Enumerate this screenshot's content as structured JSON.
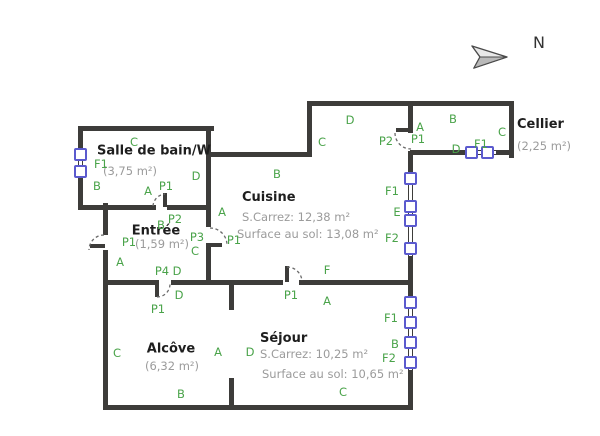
{
  "compass": {
    "label": "N"
  },
  "colors": {
    "wall": "#3d3c3a",
    "window": "#5b5ace",
    "label_green": "#4aa34a",
    "room_name": "#1e1e1e",
    "measure_gray": "#9b9b9b"
  },
  "rooms": {
    "bathroom": {
      "name": "Salle de bain/W",
      "area": "(3,75 m²)"
    },
    "entree": {
      "name": "Entrée",
      "area": "(1,59 m²)"
    },
    "cuisine": {
      "name": "Cuisine",
      "carrez": "S.Carrez: 12,38 m²",
      "floor": "Surface au sol: 13,08 m²"
    },
    "sejour": {
      "name": "Séjour",
      "carrez": "S.Carrez: 10,25 m²",
      "floor": "Surface au sol: 10,65 m²"
    },
    "alcove": {
      "name": "Alcôve",
      "area": "(6,32 m²)"
    },
    "cellier": {
      "name": "Cellier",
      "area": "(2,25 m²)"
    }
  },
  "wall_labels": [
    {
      "text": "C",
      "x": 134,
      "y": 142
    },
    {
      "text": "F1",
      "x": 101,
      "y": 164
    },
    {
      "text": "B",
      "x": 97,
      "y": 186
    },
    {
      "text": "D",
      "x": 196,
      "y": 176
    },
    {
      "text": "A",
      "x": 148,
      "y": 191
    },
    {
      "text": "P1",
      "x": 166,
      "y": 186
    },
    {
      "text": "B",
      "x": 161,
      "y": 225
    },
    {
      "text": "P2",
      "x": 175,
      "y": 219
    },
    {
      "text": "P3",
      "x": 197,
      "y": 237
    },
    {
      "text": "C",
      "x": 195,
      "y": 251
    },
    {
      "text": "P1",
      "x": 129,
      "y": 242
    },
    {
      "text": "A",
      "x": 120,
      "y": 262
    },
    {
      "text": "P4",
      "x": 162,
      "y": 271
    },
    {
      "text": "D",
      "x": 177,
      "y": 271
    },
    {
      "text": "D",
      "x": 179,
      "y": 295
    },
    {
      "text": "P1",
      "x": 158,
      "y": 309
    },
    {
      "text": "C",
      "x": 322,
      "y": 142
    },
    {
      "text": "D",
      "x": 350,
      "y": 120
    },
    {
      "text": "B",
      "x": 277,
      "y": 174
    },
    {
      "text": "A",
      "x": 222,
      "y": 212
    },
    {
      "text": "P1",
      "x": 234,
      "y": 240
    },
    {
      "text": "F1",
      "x": 392,
      "y": 191
    },
    {
      "text": "E",
      "x": 397,
      "y": 212
    },
    {
      "text": "F2",
      "x": 392,
      "y": 238
    },
    {
      "text": "F",
      "x": 327,
      "y": 270
    },
    {
      "text": "P2",
      "x": 386,
      "y": 141
    },
    {
      "text": "A",
      "x": 420,
      "y": 127
    },
    {
      "text": "P1",
      "x": 418,
      "y": 139
    },
    {
      "text": "B",
      "x": 453,
      "y": 119
    },
    {
      "text": "C",
      "x": 502,
      "y": 132
    },
    {
      "text": "D",
      "x": 456,
      "y": 149
    },
    {
      "text": "F1",
      "x": 481,
      "y": 144
    },
    {
      "text": "A",
      "x": 327,
      "y": 301
    },
    {
      "text": "P1",
      "x": 291,
      "y": 295
    },
    {
      "text": "D",
      "x": 250,
      "y": 352
    },
    {
      "text": "F1",
      "x": 391,
      "y": 318
    },
    {
      "text": "B",
      "x": 395,
      "y": 344
    },
    {
      "text": "F2",
      "x": 389,
      "y": 358
    },
    {
      "text": "C",
      "x": 343,
      "y": 392
    },
    {
      "text": "C",
      "x": 117,
      "y": 353
    },
    {
      "text": "A",
      "x": 218,
      "y": 352
    },
    {
      "text": "B",
      "x": 181,
      "y": 394
    }
  ]
}
